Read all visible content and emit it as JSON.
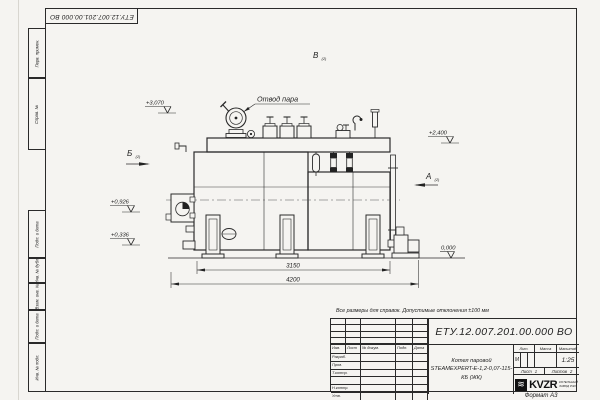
{
  "frame": {
    "top_stamp": "ЕТУ.12.007.201.00.000 ВО",
    "format_label": "Формат А3",
    "margin_columns": [
      "Перв. примен.",
      "Справ. №",
      "Подп. и дата",
      "Инв. № дубл.",
      "Взам. инв. №",
      "Подп. и дата",
      "Инв. № подл."
    ]
  },
  "note": "Все размеры для справок. Допустимые отклонения ±100 мм",
  "title_block": {
    "designation": "ЕТУ.12.007.201.00.000  ВО",
    "name_line1": "Котел паровой",
    "name_line2": "STEAMEXPERT-Е-1,2-0,07-115-КБ (ЖК)",
    "header": [
      "Изм.",
      "Лист",
      "№ докум.",
      "Подп.",
      "Дата"
    ],
    "sig_rows": [
      "Разраб.",
      "Пров.",
      "Т.контр.",
      "",
      "Н.контр.",
      "Утв."
    ],
    "lit_label": "Лит.",
    "lit_value": "М",
    "mass_label": "Масса",
    "scale_label": "Масштаб",
    "scale_value": "1:25",
    "sheet_label": "Лист",
    "sheet_value": "1",
    "sheets_label": "Листов",
    "sheets_value": "2",
    "logo_glyph": "≋",
    "logo_text": "KVZR",
    "logo_sub1": "КОТЕЛЬНЫЙ",
    "logo_sub2": "ЗАВОД РЭП"
  },
  "drawing": {
    "callout_steam": "Отвод пара",
    "views": [
      {
        "label": "Б",
        "ref": "(2)"
      },
      {
        "label": "В",
        "ref": "(2)"
      },
      {
        "label": "А",
        "ref": "(2)"
      }
    ],
    "elevations": [
      "+3,070",
      "+2,400",
      "+0,926",
      "+0,336",
      "0,000"
    ],
    "dim_inner": "3150",
    "dim_overall": "4200"
  }
}
